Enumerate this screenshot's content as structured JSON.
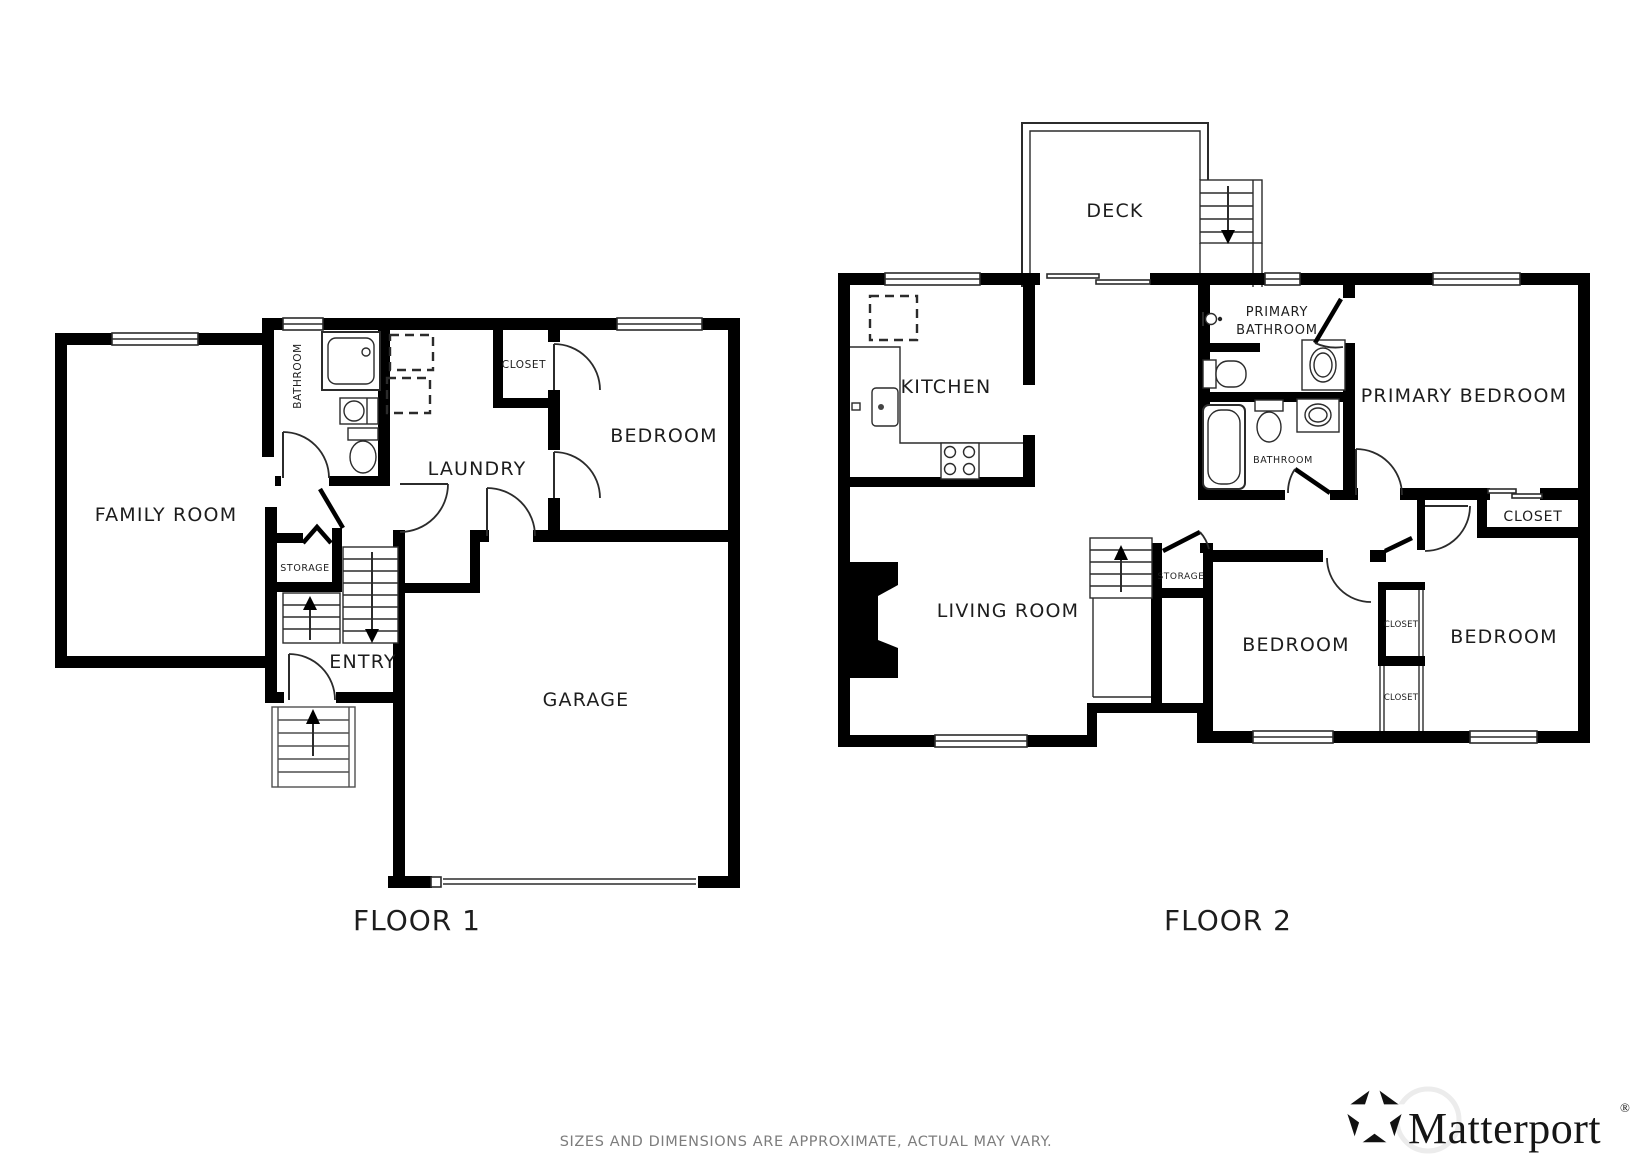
{
  "floor1": {
    "title": "FLOOR 1",
    "rooms": {
      "family_room": "FAMILY ROOM",
      "bathroom": "BATHROOM",
      "laundry": "LAUNDRY",
      "closet": "CLOSET",
      "bedroom": "BEDROOM",
      "storage": "STORAGE",
      "entry": "ENTRY",
      "garage": "GARAGE"
    }
  },
  "floor2": {
    "title": "FLOOR 2",
    "rooms": {
      "deck": "DECK",
      "kitchen": "KITCHEN",
      "primary_bathroom_line1": "PRIMARY",
      "primary_bathroom_line2": "BATHROOM",
      "primary_bedroom": "PRIMARY BEDROOM",
      "bathroom": "BATHROOM",
      "closet": "CLOSET",
      "living_room": "LIVING ROOM",
      "storage": "STORAGE",
      "bedroom_left": "BEDROOM",
      "closet_left": "CLOSET",
      "closet_right": "CLOSET",
      "bedroom_right": "BEDROOM"
    }
  },
  "footer": {
    "disclaimer": "SIZES AND DIMENSIONS ARE APPROXIMATE, ACTUAL MAY VARY."
  },
  "branding": {
    "name": "Matterport",
    "registered": "®"
  },
  "colors": {
    "wall": "#000000",
    "label": "#1d1d1d",
    "muted_text": "#7d7d7d"
  }
}
